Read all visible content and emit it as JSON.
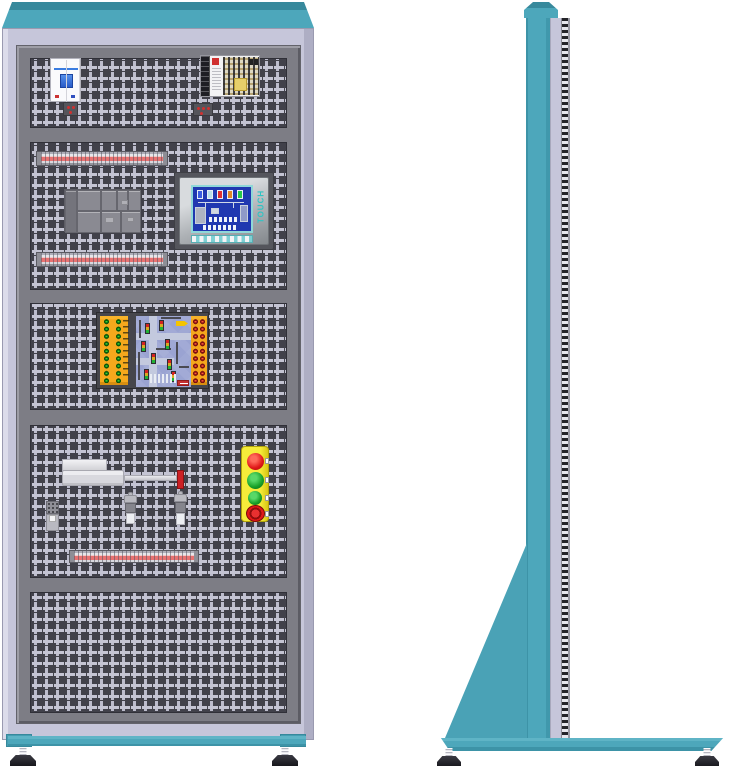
{
  "scene": {
    "type": "equipment-illustration",
    "subject": "electrical-training-cabinet",
    "views": [
      "front-view",
      "side-view"
    ]
  },
  "front_view": {
    "sections": [
      {
        "name": "power-section",
        "components": [
          "circuit-breaker",
          "terminal-block",
          "switching-power-supply",
          "terminal-block"
        ]
      },
      {
        "name": "control-section",
        "components": [
          "din-terminal-rail",
          "relay-module-group",
          "hmi-touch-panel",
          "din-terminal-rail"
        ]
      },
      {
        "name": "plc-section",
        "components": [
          "traffic-light-training-board"
        ]
      },
      {
        "name": "actuator-section",
        "components": [
          "pneumatic-cylinder",
          "mini-relay",
          "proximity-sensor",
          "proximity-sensor",
          "push-button-station",
          "din-terminal-rail"
        ]
      },
      {
        "name": "empty-section",
        "components": []
      }
    ],
    "push_button_station": {
      "buttons": [
        "red-button",
        "green-button",
        "green-button",
        "emergency-stop-button"
      ]
    },
    "training_board": {
      "left_jacks": "green",
      "right_jacks": "red",
      "center": "traffic-intersection-mimic"
    }
  },
  "hmi": {
    "touch_label": "TOUCH",
    "screen_bar_colors": [
      "#3a5ce0",
      "#b8e0e8",
      "#e03030",
      "#e08828",
      "#28c84a"
    ]
  },
  "side_view": {
    "components": [
      "cabinet-column",
      "perforation-edge-strip",
      "support-bracket",
      "base-plate",
      "leveling-foot",
      "leveling-foot"
    ]
  },
  "colors": {
    "teal": "#4da7bb",
    "teal_dark": "#37899c",
    "lavender": "#c6c6da",
    "frame_gray": "#7d7d85",
    "perforation_dark": "#41414a",
    "perforation_light": "#c4c4d3",
    "rail_red": "#e87272",
    "station_yellow": "#f5ec3a",
    "button_red": "#e01818",
    "button_green": "#18a028",
    "board_orange": "#f5a81c",
    "board_blue": "#9aa3d2",
    "jack_green": "#35d435",
    "jack_red": "#ff5838",
    "screen_blue": "#2038b0",
    "screen_border_teal": "#8fd8d8",
    "touch_text": "#2fc4c4"
  }
}
